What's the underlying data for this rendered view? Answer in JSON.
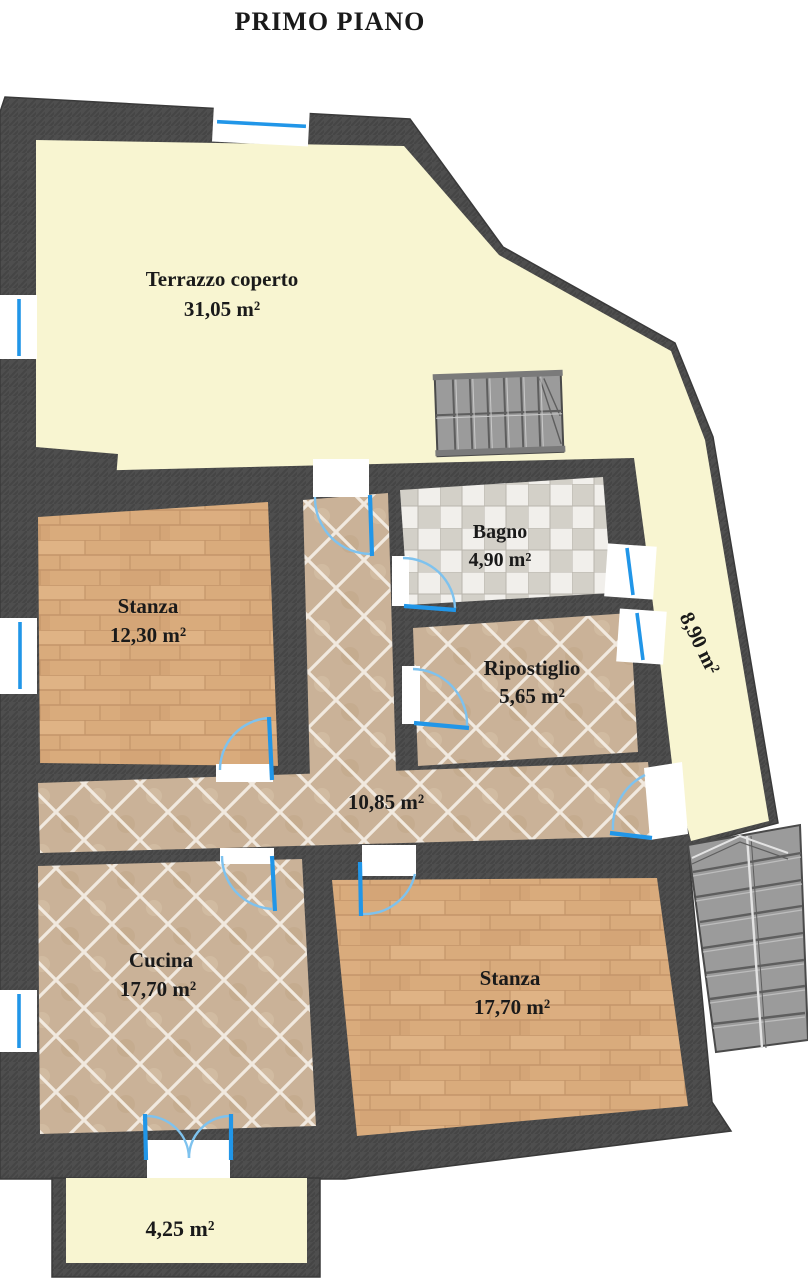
{
  "title": "PRIMO PIANO",
  "rooms": {
    "terrazzo": {
      "name": "Terrazzo coperto",
      "area": "31,05 m²"
    },
    "stanza1": {
      "name": "Stanza",
      "area": "12,30 m²"
    },
    "bagno": {
      "name": "Bagno",
      "area": "4,90 m²"
    },
    "ripostiglio": {
      "name": "Ripostiglio",
      "area": "5,65 m²"
    },
    "disimpegno": {
      "area": "10,85 m²"
    },
    "terrazzino": {
      "area": "8,90 m²"
    },
    "cucina": {
      "name": "Cucina",
      "area": "17,70 m²"
    },
    "stanza2": {
      "name": "Stanza",
      "area": "17,70 m²"
    },
    "balcone": {
      "area": "4,25 m²"
    }
  },
  "colors": {
    "background": "#ffffff",
    "wall": "#4e4e4e",
    "wall_hatch": "#454545",
    "outline": "#3a3a3a",
    "terrace_floor": "#f8f5d1",
    "wood_floor": "#d9ab7c",
    "wood_grain": "#c4956a",
    "tile_floor": "#cab298",
    "tile_grout": "#f3ece2",
    "checker_light": "#f1efeb",
    "checker_dark": "#d3d0c8",
    "checker_grid": "#b9b6ae",
    "window_blue": "#2196e8",
    "door_arc_blue": "#7ec2ee",
    "stairs_fill": "#9b9b9b",
    "stairs_line": "#5e5e5e",
    "label_text": "#1a1a1a"
  }
}
